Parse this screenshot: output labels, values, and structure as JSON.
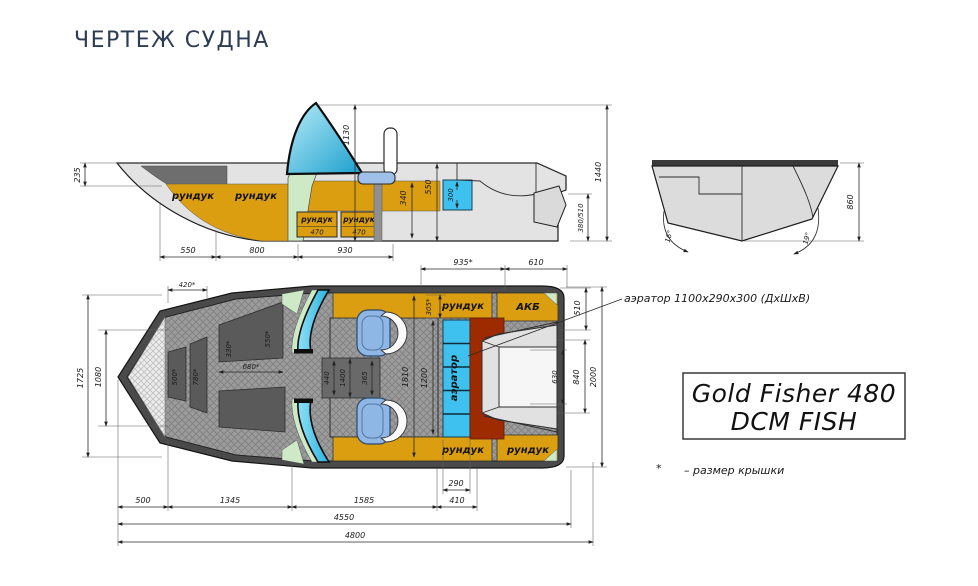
{
  "title": "ЧЕРТЕЖ СУДНА",
  "side_view": {
    "lockers": [
      "рундук",
      "рундук"
    ],
    "locker_boxes": [
      {
        "label": "рундук",
        "size": "470"
      },
      {
        "label": "рундук",
        "size": "470"
      }
    ],
    "dims": {
      "bow_height": "235",
      "windshield_height": "1130",
      "seat_depth": "340",
      "cockpit_depth": "550",
      "livewell": "300",
      "transom_height": "380/510",
      "overall_height": "1440",
      "len_bow": "550",
      "len_mid": "800",
      "len_cockpit": "930"
    }
  },
  "transom_view": {
    "dims": {
      "height": "860",
      "deadrise_port": "16°",
      "deadrise_starboard": "19°"
    }
  },
  "plan_view": {
    "labels": {
      "locker_top": "рундук",
      "battery": "АКБ",
      "aerator": "аэратор",
      "locker_bottom_left": "рундук",
      "locker_bottom_right": "рундук"
    },
    "dims": {
      "hatch_420": "420*",
      "hatch_500": "500*",
      "hatch_780": "780*",
      "hatch_330": "330*",
      "hatch_550": "550*",
      "hatch_680": "680*",
      "beam_1725": "1725",
      "bow_width_1080": "1080",
      "w_440": "440",
      "w_1400": "1400",
      "w_365": "365",
      "cockpit_1810": "1810",
      "floor_1200": "1200",
      "hatch_305": "305*",
      "aft_935": "935*",
      "aft_610": "610",
      "aft_510": "510",
      "well_630": "630",
      "well_840": "840",
      "beam_2000": "2000",
      "aerator_290": "290",
      "aerator_410": "410",
      "len_500": "500",
      "len_1345": "1345",
      "len_1585": "1585",
      "len_4550": "4550",
      "len_4800": "4800"
    }
  },
  "annotations": {
    "aerator_note": "аэратор 1100х290х300 (ДхШхВ)",
    "model_name_line1": "Gold Fisher 480",
    "model_name_line2": "DCM FISH",
    "footnote_mark": "*",
    "footnote_text": "–  размер крышки"
  },
  "colors": {
    "orange": "#DB9E10",
    "cyan": "#3EC1EE",
    "dark_red": "#9E2B00",
    "pale_green": "#CDE9C6",
    "seat_blue": "#8FB7E6",
    "title": "#2d3c55"
  }
}
